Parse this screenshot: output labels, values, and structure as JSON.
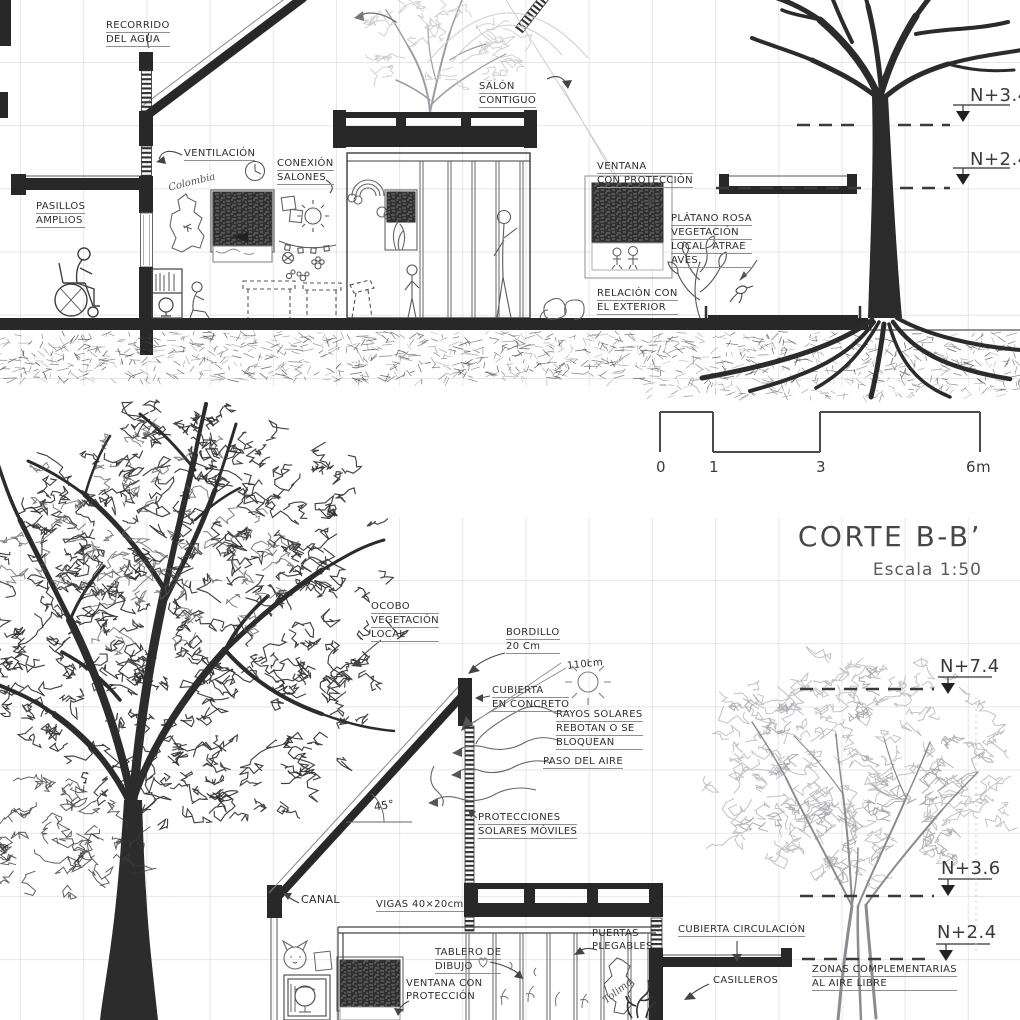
{
  "title_block": {
    "title": "CORTE B-B’",
    "scale_note": "Escala 1:50"
  },
  "scale_bar": {
    "tick_labels": [
      "0",
      "1",
      "3",
      "6m"
    ]
  },
  "elevation_markers": {
    "top_section": [
      "N+3.4",
      "N+2.4"
    ],
    "bottom_section": [
      "N+7.4",
      "N+3.6",
      "N+2.4"
    ]
  },
  "annotations": [
    {
      "name": "label-recorrido-del-agua",
      "x": 106,
      "y": 19,
      "u": 1,
      "lines": [
        "RECORRIDO",
        "DEL AGUA"
      ]
    },
    {
      "name": "label-ventilacion",
      "x": 184,
      "y": 147,
      "u": 1,
      "lines": [
        "VENTILACIÓN"
      ]
    },
    {
      "name": "label-conexion-salones",
      "x": 277,
      "y": 157,
      "u": 1,
      "lines": [
        "CONEXIÓN",
        "SALONES"
      ]
    },
    {
      "name": "label-pasillos-amplios",
      "x": 36,
      "y": 200,
      "u": 1,
      "lines": [
        "PASILLOS",
        "AMPLIOS"
      ]
    },
    {
      "name": "label-colombia",
      "x": 168,
      "y": 176,
      "cls": "script",
      "rot": -14,
      "lines": [
        "Colombia"
      ]
    },
    {
      "name": "label-salon-contiguo",
      "x": 479,
      "y": 80,
      "u": 1,
      "lines": [
        "SALÓN",
        "CONTIGUO"
      ]
    },
    {
      "name": "label-ventana-con-proteccion-top",
      "x": 597,
      "y": 160,
      "u": 1,
      "lines": [
        "VENTANA",
        "CON PROTECCIÓN"
      ]
    },
    {
      "name": "label-platano-rosa",
      "x": 671,
      "y": 212,
      "u": 1,
      "lines": [
        "PLÁTANO ROSA",
        "VEGETACIÓN",
        "LOCAL  ATRAE",
        "AVES."
      ]
    },
    {
      "name": "label-relacion-con-el-exterior",
      "x": 597,
      "y": 287,
      "u": 1,
      "lines": [
        "RELACIÓN CON",
        "EL EXTERIOR"
      ]
    },
    {
      "name": "label-level-n34",
      "x": 970,
      "y": 84,
      "size": 18,
      "cls": "big",
      "lines": [
        "N+3.4"
      ]
    },
    {
      "name": "label-level-n24-top",
      "x": 970,
      "y": 148,
      "size": 18,
      "cls": "big",
      "lines": [
        "N+2.4"
      ]
    },
    {
      "name": "scalebar-tick-0",
      "x": 656,
      "y": 458,
      "size": 15,
      "cls": "big",
      "lines": [
        "0"
      ]
    },
    {
      "name": "scalebar-tick-1",
      "x": 709,
      "y": 458,
      "size": 15,
      "cls": "big",
      "lines": [
        "1"
      ]
    },
    {
      "name": "scalebar-tick-3",
      "x": 816,
      "y": 458,
      "size": 15,
      "cls": "big",
      "lines": [
        "3"
      ]
    },
    {
      "name": "scalebar-tick-6m",
      "x": 966,
      "y": 458,
      "size": 15,
      "cls": "big",
      "lines": [
        "6m"
      ]
    },
    {
      "name": "label-ocobo",
      "x": 371,
      "y": 600,
      "u": 1,
      "lines": [
        "OCOBO",
        "VEGETACIÓN",
        "LOCAL"
      ]
    },
    {
      "name": "label-bordillo",
      "x": 506,
      "y": 626,
      "u": 1,
      "lines": [
        "BORDILLO",
        "20 Cm"
      ]
    },
    {
      "name": "label-110cm",
      "x": 567,
      "y": 658,
      "size": 10,
      "rot": -6,
      "lines": [
        "110cm"
      ]
    },
    {
      "name": "label-cubierta-en-concreto",
      "x": 492,
      "y": 684,
      "u": 1,
      "lines": [
        "CUBIERTA",
        "EN CONCRETO"
      ]
    },
    {
      "name": "label-rayos-solares",
      "x": 556,
      "y": 708,
      "u": 1,
      "lines": [
        "RAYOS SOLARES",
        "REBOTAN O SE",
        "BLOQUEAN"
      ]
    },
    {
      "name": "label-paso-del-aire",
      "x": 543,
      "y": 755,
      "u": 1,
      "lines": [
        "PASO DEL AIRE"
      ]
    },
    {
      "name": "label-protecciones-solares",
      "x": 478,
      "y": 811,
      "u": 1,
      "lines": [
        "PROTECCIONES",
        "SOLARES MÓVILES"
      ]
    },
    {
      "name": "label-angulo-45",
      "x": 374,
      "y": 799,
      "size": 11,
      "rot": -10,
      "lines": [
        "45°"
      ]
    },
    {
      "name": "label-canal",
      "x": 301,
      "y": 893,
      "size": 11,
      "lines": [
        "CANAL"
      ]
    },
    {
      "name": "label-vigas",
      "x": 376,
      "y": 898,
      "u": 1,
      "lines": [
        "VIGAS 40×20cm"
      ]
    },
    {
      "name": "label-puertas-plegables",
      "x": 592,
      "y": 927,
      "lines": [
        "PUERTAS",
        "PLEGABLES"
      ]
    },
    {
      "name": "label-tablero-de-dibujo",
      "x": 435,
      "y": 946,
      "u": 1,
      "lines": [
        "TABLERO DE",
        "DIBUJO"
      ]
    },
    {
      "name": "label-ventana-con-proteccion-bottom",
      "x": 406,
      "y": 977,
      "lines": [
        "VENTANA CON",
        "PROTECCIÓN"
      ]
    },
    {
      "name": "label-cubierta-circulacion",
      "x": 678,
      "y": 923,
      "u": 1,
      "lines": [
        "CUBIERTA CIRCULACIÓN"
      ]
    },
    {
      "name": "label-casilleros",
      "x": 713,
      "y": 974,
      "lines": [
        "CASILLEROS"
      ]
    },
    {
      "name": "label-zonas-complementarias",
      "x": 812,
      "y": 963,
      "u": 1,
      "lines": [
        "ZONAS COMPLEMENTARIAS",
        "AL AIRE LIBRE"
      ]
    },
    {
      "name": "label-level-n74",
      "x": 940,
      "y": 655,
      "size": 18,
      "cls": "big",
      "lines": [
        "N+7.4"
      ]
    },
    {
      "name": "label-level-n36",
      "x": 941,
      "y": 857,
      "size": 18,
      "cls": "big",
      "lines": [
        "N+3.6"
      ]
    },
    {
      "name": "label-level-n24-bottom",
      "x": 937,
      "y": 921,
      "size": 18,
      "cls": "big",
      "lines": [
        "N+2.4"
      ]
    },
    {
      "name": "label-tolima",
      "x": 601,
      "y": 985,
      "cls": "script",
      "rot": -38,
      "lines": [
        "Tolima"
      ]
    }
  ]
}
